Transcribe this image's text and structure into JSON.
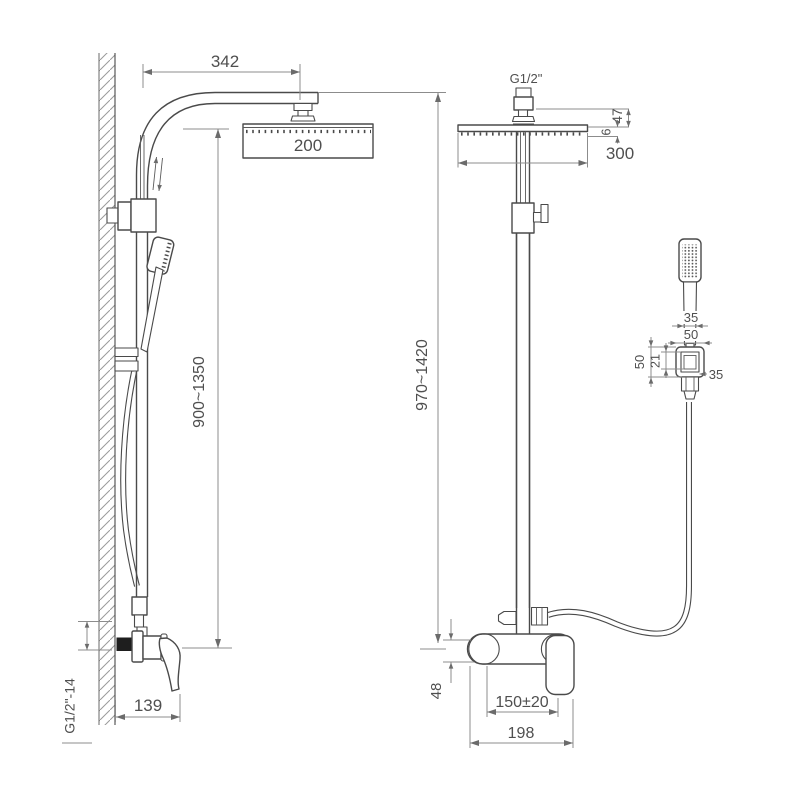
{
  "drawing_colors": {
    "line": "#4a4a4a",
    "dimension": "#8c8c8c",
    "text": "#4f4f4f",
    "background": "#ffffff",
    "inlet_fill": "#1e1e1e"
  },
  "left_view": {
    "arm_reach": "342",
    "head_depth": "200",
    "height_range": "900~1350",
    "mixer_offset": "139",
    "inlet_thread": "G1/2\"-14"
  },
  "right_view": {
    "top_thread": "G1/2\"",
    "head_drop": "47",
    "head_thickness": "6",
    "head_width": "300",
    "height_range": "970~1420",
    "handset_width": "35",
    "holder_width": "50",
    "holder_height": "50",
    "holder_inner_height": "21",
    "holder_side": "35",
    "body_height": "48",
    "inlet_spacing": "150±20",
    "body_width": "198"
  }
}
